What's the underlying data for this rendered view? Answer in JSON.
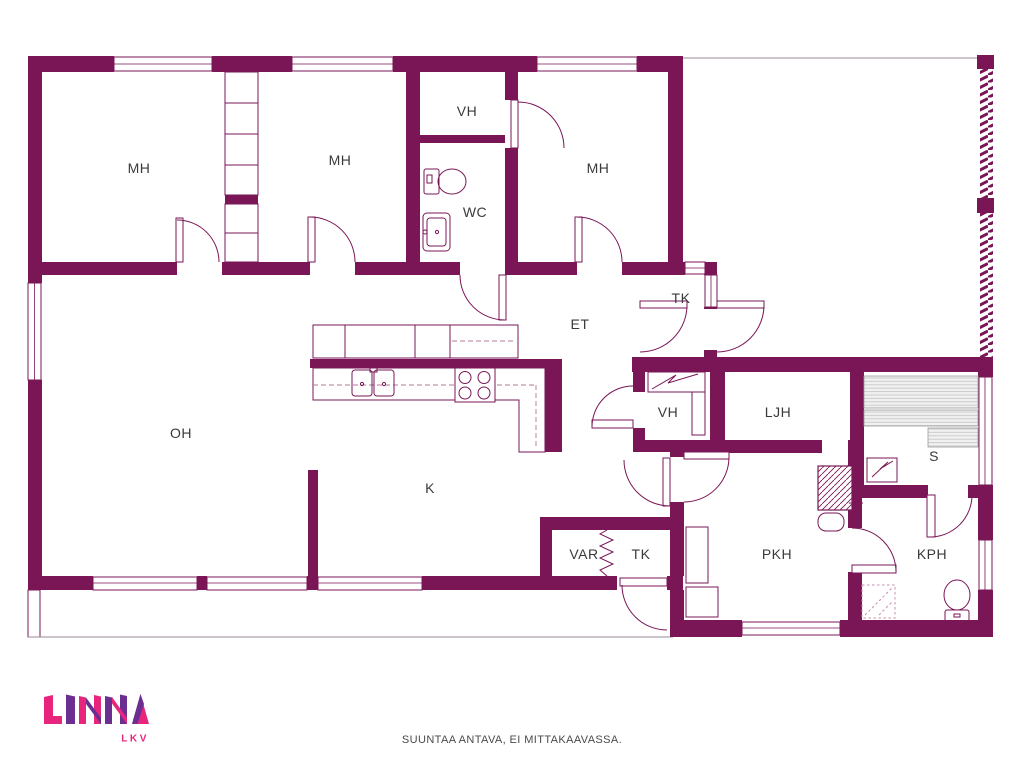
{
  "title": "Floor plan",
  "colors": {
    "wall": "#7A1656",
    "logo_pink": "#E8257D",
    "logo_purple": "#6B2E91"
  },
  "rooms": [
    {
      "id": "mh-1",
      "label": "MH"
    },
    {
      "id": "mh-2",
      "label": "MH"
    },
    {
      "id": "vh-top",
      "label": "VH"
    },
    {
      "id": "wc",
      "label": "WC"
    },
    {
      "id": "mh-3",
      "label": "MH"
    },
    {
      "id": "et",
      "label": "ET"
    },
    {
      "id": "tk-entry",
      "label": "TK"
    },
    {
      "id": "oh",
      "label": "OH"
    },
    {
      "id": "k",
      "label": "K"
    },
    {
      "id": "vh-lower",
      "label": "VH"
    },
    {
      "id": "ljh",
      "label": "LJH"
    },
    {
      "id": "s",
      "label": "S"
    },
    {
      "id": "var",
      "label": "VAR"
    },
    {
      "id": "tk-lower",
      "label": "TK"
    },
    {
      "id": "pkh",
      "label": "PKH"
    },
    {
      "id": "kph",
      "label": "KPH"
    }
  ],
  "logo": {
    "name": "LINNA",
    "subtitle": "LKV"
  },
  "footer": {
    "disclaimer": "SUUNTAA ANTAVA, EI MITTAKAAVASSA."
  }
}
